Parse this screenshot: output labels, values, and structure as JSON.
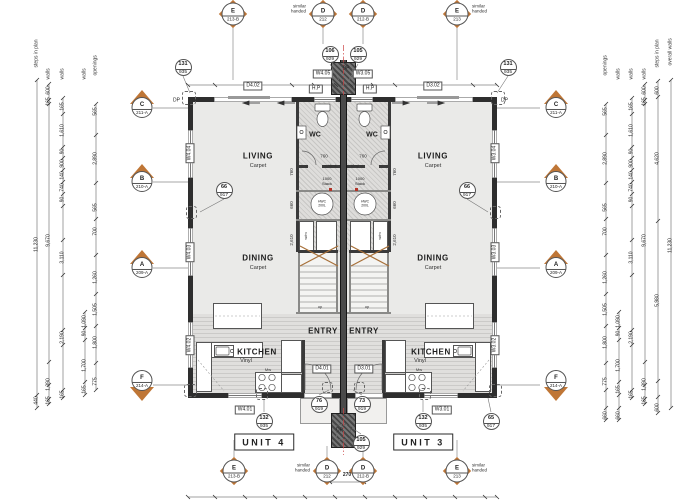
{
  "colors": {
    "accent_orange": "#bf7636",
    "wall": "#2e2e2e",
    "room_fill": "#eaeae8",
    "centerline_red": "#cc4444"
  },
  "units": {
    "unit4": "UNIT 4",
    "unit3": "UNIT 3"
  },
  "rooms": {
    "living": "LIVING",
    "dining": "DINING",
    "kitchen": "KITCHEN",
    "entry": "ENTRY",
    "wc": "WC",
    "carpet": "Carpet",
    "vinyl": "Vinyl"
  },
  "fixtures": {
    "stack_num": "1000",
    "stack_word": "Stack",
    "hwc": "HWC 200L",
    "wm": "w/m",
    "mw": "Mw",
    "up": "up",
    "dp": "DP",
    "hp": "H.P"
  },
  "tags": {
    "d402": "D4.02",
    "d302": "D3.02",
    "w405": "W4.05",
    "w305": "W3.05",
    "w404": "W4.04",
    "w403": "W4.03",
    "w402": "W4.02",
    "w401": "W4.01",
    "w304": "W3.04",
    "w303": "W3.03",
    "w302": "W3.02",
    "w301": "W3.01",
    "d401": "D4.01",
    "d301": "D3.01"
  },
  "grid": {
    "c": {
      "letter": "C",
      "code": "211-A"
    },
    "b": {
      "letter": "B",
      "code": "210-A"
    },
    "a": {
      "letter": "A",
      "code": "209-A"
    },
    "f": {
      "letter": "F",
      "code": "214-A"
    }
  },
  "doors": {
    "e4": {
      "letter": "E",
      "code": "213-B"
    },
    "d4": {
      "letter": "D",
      "code": "212"
    },
    "d3b": {
      "letter": "D",
      "code": "212-B"
    },
    "e3": {
      "letter": "E",
      "code": "213"
    }
  },
  "notes": {
    "similar1": "similar",
    "similar2": "handed"
  },
  "refs": {
    "c131": {
      "a": "131",
      "b": "935"
    },
    "c106": {
      "a": "106",
      "b": "929"
    },
    "c105": {
      "a": "105",
      "b": "929"
    },
    "c66": {
      "a": "66",
      "b": "917"
    },
    "c76": {
      "a": "76",
      "b": "919"
    },
    "c73": {
      "a": "73",
      "b": "919"
    },
    "c132": {
      "a": "132",
      "b": "935"
    },
    "c65": {
      "a": "65",
      "b": "917"
    }
  },
  "headers": {
    "l": [
      "steps in plan",
      "walls",
      "walls",
      "walls",
      "openings"
    ],
    "r": [
      "openings",
      "walls",
      "walls",
      "walls",
      "steps in plan",
      "overall walls"
    ]
  },
  "dims": {
    "l1": [
      "11,230",
      "440"
    ],
    "l2": [
      "600",
      "165",
      "9,670",
      "1,390",
      "165"
    ],
    "l3": [
      "165",
      "1,610",
      "90",
      "900",
      "140",
      "740",
      "90",
      "3,110",
      "2,190",
      "165"
    ],
    "l4": [
      "1,090",
      "90",
      "1,700",
      "165"
    ],
    "l5": [
      "565",
      "2,890",
      "565",
      "700",
      "1,260",
      "1,505",
      "1,800",
      "775"
    ],
    "r5": [
      "600",
      "4,620",
      "5,980",
      "600"
    ],
    "r6": [
      "11,230"
    ],
    "extra660": "660",
    "core": {
      "d760": "760",
      "d660": "660",
      "d2610": "2,610",
      "d270": "270"
    }
  }
}
